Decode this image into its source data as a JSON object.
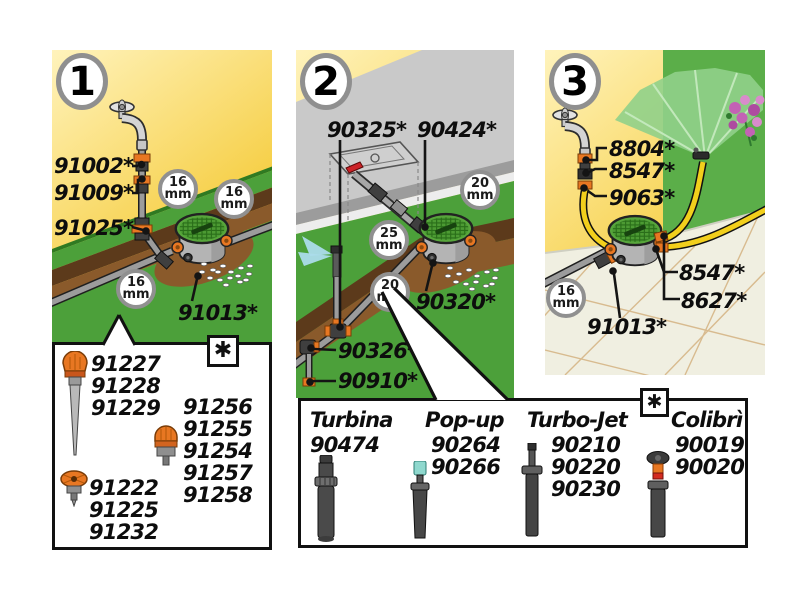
{
  "colors": {
    "background_yellow_light": "#FFF3BC",
    "background_yellow_deep": "#F3C31F",
    "lawn_green": "#4CA03A",
    "lawn_green_dark": "#2F7A22",
    "soil_dark": "#5C3A1B",
    "soil_mid": "#8A5A2B",
    "wall_gray": "#C9C9C9",
    "tile_beige": "#F0EFE1",
    "fitting_orange": "#E87722",
    "hose_yellow": "#F2CF1C",
    "valve_lid_green": "#57A63B",
    "badge_ring_gray": "#8C8C8C"
  },
  "panel1": {
    "number": "1",
    "callouts": {
      "c91002": "91002*",
      "c91009": "91009*",
      "c91025": "91025*",
      "c91013": "91013*"
    },
    "badge_16": {
      "value": "16",
      "unit": "mm"
    }
  },
  "parts_box1": {
    "asterisk": "✱",
    "spike_group": [
      "91227",
      "91228",
      "91229"
    ],
    "right_group": [
      "91256",
      "91255",
      "91254",
      "91257",
      "91258"
    ],
    "micro_group": [
      "91222",
      "91225",
      "91232"
    ]
  },
  "panel2": {
    "number": "2",
    "callouts": {
      "c90325": "90325*",
      "c90424": "90424*",
      "c90320": "90320*",
      "c90326": "90326*",
      "c90910": "90910*"
    },
    "badge_20": {
      "value": "20",
      "unit": "mm"
    },
    "badge_25": {
      "value": "25",
      "unit": "mm"
    }
  },
  "parts_box2": {
    "asterisk": "✱",
    "columns": [
      {
        "name": "Turbina",
        "icon": "turbina-sprinkler-icon",
        "codes": [
          "90474"
        ]
      },
      {
        "name": "Pop-up",
        "icon": "pop-up-sprinkler-icon",
        "codes": [
          "90264",
          "90266"
        ]
      },
      {
        "name": "Turbo-Jet",
        "icon": "turbo-jet-sprinkler-icon",
        "codes": [
          "90210",
          "90220",
          "90230"
        ]
      },
      {
        "name": "Colibrì",
        "icon": "colibri-sprinkler-icon",
        "codes": [
          "90019",
          "90020"
        ]
      }
    ]
  },
  "panel3": {
    "number": "3",
    "callouts": {
      "c8804": "8804*",
      "c8547_top": "8547*",
      "c9063": "9063*",
      "c8547_bottom": "8547*",
      "c8627": "8627*",
      "c91013": "91013*"
    },
    "badge_16": {
      "value": "16",
      "unit": "mm"
    }
  }
}
